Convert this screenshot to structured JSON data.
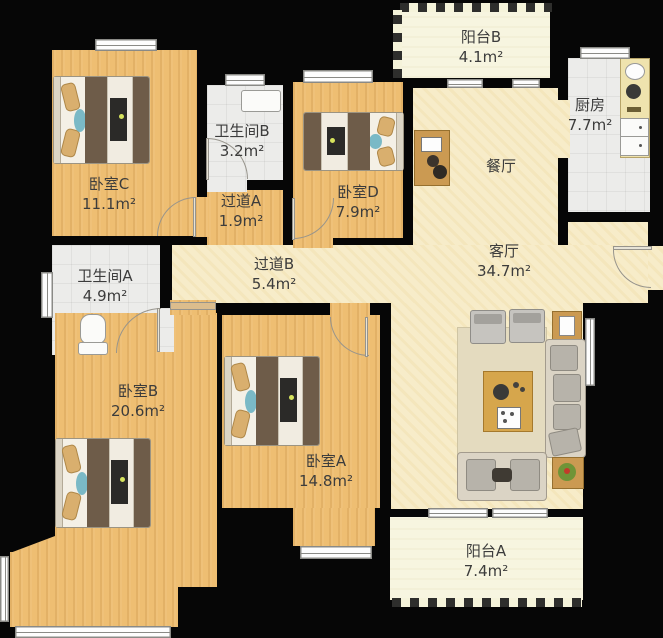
{
  "rooms": {
    "bedroom_c": {
      "name": "卧室C",
      "area": "11.1m²"
    },
    "bathroom_b": {
      "name": "卫生间B",
      "area": "3.2m²"
    },
    "hallway_a": {
      "name": "过道A",
      "area": "1.9m²"
    },
    "bedroom_d": {
      "name": "卧室D",
      "area": "7.9m²"
    },
    "balcony_b": {
      "name": "阳台B",
      "area": "4.1m²"
    },
    "kitchen": {
      "name": "厨房",
      "area": "7.7m²"
    },
    "dining": {
      "name": "餐厅"
    },
    "living": {
      "name": "客厅",
      "area": "34.7m²"
    },
    "hallway_b": {
      "name": "过道B",
      "area": "5.4m²"
    },
    "bathroom_a": {
      "name": "卫生间A",
      "area": "4.9m²"
    },
    "bedroom_b": {
      "name": "卧室B",
      "area": "20.6m²"
    },
    "bedroom_a": {
      "name": "卧室A",
      "area": "14.8m²"
    },
    "balcony_a": {
      "name": "阳台A",
      "area": "7.4m²"
    }
  },
  "colors": {
    "wall": "#060606",
    "wood_floor": "#eebe72",
    "living_floor": "#f7ecc9",
    "tile_floor": "#ececea",
    "balcony_floor": "#f7f5e0",
    "label_text": "#3c3c3c",
    "bed_duvet": "#6e5c49",
    "pillow": "#d9af6e",
    "accent_teal": "#7ab9c6",
    "sofa": "#dbd4c5",
    "table_wood": "#d6a64c"
  }
}
